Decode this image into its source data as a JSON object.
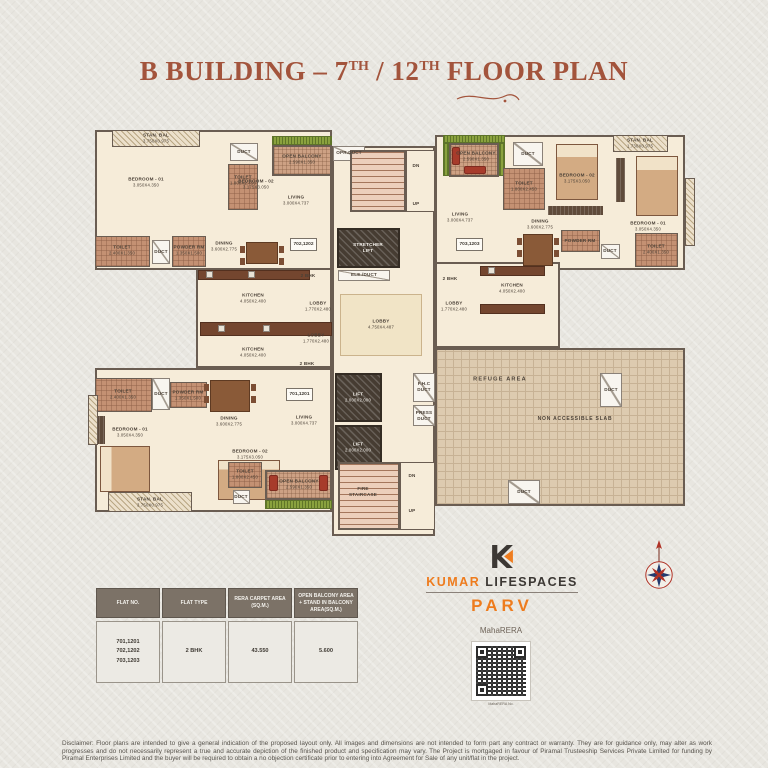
{
  "title": {
    "p1": "B BUILDING – 7",
    "s1": "TH",
    "p2": " / 12",
    "s2": "TH",
    "p3": " FLOOR PLAN"
  },
  "plan": {
    "rooms": {
      "bedroom1": {
        "name": "BEDROOM - 01",
        "dim": "3.050X4.350"
      },
      "bedroom2": {
        "name": "BEDROOM - 02",
        "dim": "3.175X3.050"
      },
      "living": {
        "name": "LIVING",
        "dim": "3.000X4.737"
      },
      "dining": {
        "name": "DINING",
        "dim": "3.600X2.775"
      },
      "kitchen": {
        "name": "KITCHEN",
        "dim": "4.050X2.400"
      },
      "toilet_large": {
        "name": "TOILET",
        "dim": "1.800X2.450"
      },
      "toilet_small": {
        "name": "TOILET",
        "dim": "2.400X1.350"
      },
      "powder": {
        "name": "POWDER RM",
        "dim": "1.350X1.500"
      },
      "stan_bal_l": {
        "name": "STAN. BAL",
        "dim": "3.750X0.975"
      },
      "stan_bal_r": {
        "name": "STAN. BAL",
        "dim": "1.730X0.975"
      },
      "open_balcony": {
        "name": "OPEN BALCONY",
        "dim": "2.590X1.350"
      },
      "lobby_small": {
        "name": "LOBBY",
        "dim": "1.770X2.480"
      },
      "lobby_main": {
        "name": "LOBBY",
        "dim": "4.750X4.487"
      },
      "lift": {
        "name": "LIFT",
        "dim": "2.000X2.000"
      },
      "stretcher_lift": {
        "name": "STRETCHER LIFT"
      },
      "fire_staircase": {
        "name": "FIRE STAIRCASE"
      }
    },
    "labels": {
      "duct": "DUCT",
      "opr_duct": "OPR.DUCT",
      "ele_duct": "ELE./DUCT",
      "fhc_duct": "F.H.C DUCT",
      "press_duct": "PRESS DUCT",
      "up": "UP",
      "dn": "DN",
      "bhk": "2 BHK",
      "refuge": "REFUGE AREA",
      "non_accessible": "NON ACCESSIBLE SLAB"
    },
    "flats": {
      "f701": "701,1201",
      "f702": "702,1202",
      "f703": "703,1203"
    }
  },
  "brand": {
    "kumar": "KUMAR",
    "lifespaces": "LIFESPACES",
    "parv": "PARV",
    "maharera": "MahaRERA",
    "qr_caption": "MahaRERA No."
  },
  "table": {
    "headers": [
      "FLAT NO.",
      "FLAT TYPE",
      "RERA CARPET AREA (SQ.M.)",
      "OPEN BALCONY AREA + STAND IN BALCONY AREA(SQ.M.)"
    ],
    "row": {
      "flat_no": [
        "701,1201",
        "702,1202",
        "703,1203"
      ],
      "flat_type": "2 BHK",
      "carpet_area": "43.550",
      "balcony_area": "5.600"
    }
  },
  "disclaimer": "Disclaimer: Floor plans are intended to give a general indication of the proposed layout only. All images and dimensions are not intended to form part any contract or warranty. They are for guidance only, may alter as work progresses and do not necessarily represent a true and accurate depiction of the finished product and specification may vary. The Project is mortgaged in favour of Piramal Trusteeship Services Private Limited for funding by Piramal Enterprises Limited and the buyer will be required to obtain a no objection certificate prior to entering into Agreement for Sale of any unit/flat in the project.",
  "colors": {
    "title": "#a3543c",
    "brand_orange": "#ee7c1e",
    "brand_dark": "#3c3834",
    "wall": "#6a5d52",
    "header_bg": "#7c7267"
  }
}
